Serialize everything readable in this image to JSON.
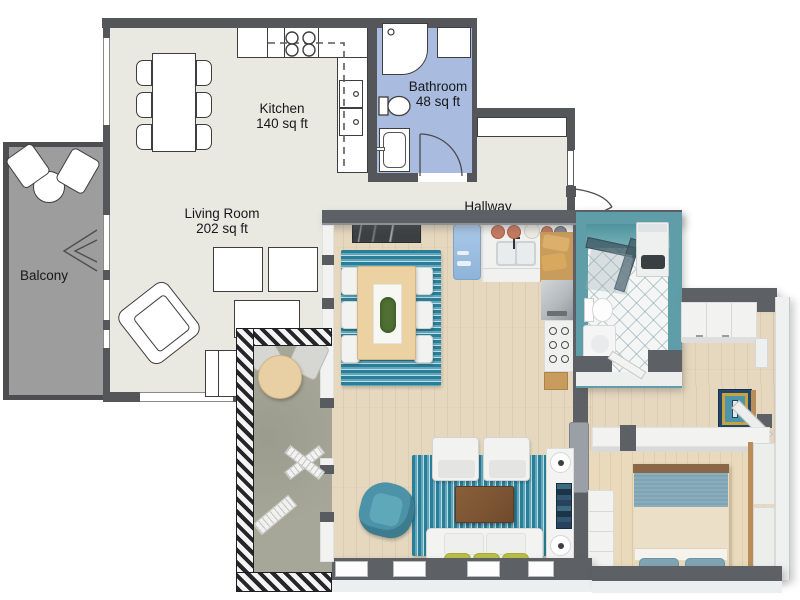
{
  "plan2d": {
    "rooms": {
      "kitchen": {
        "name": "Kitchen",
        "area": "140 sq ft"
      },
      "living_room": {
        "name": "Living Room",
        "area": "202 sq ft"
      },
      "bathroom": {
        "name": "Bathroom",
        "area": "48 sq ft"
      },
      "hallway": {
        "name": "Hallway"
      },
      "balcony": {
        "name": "Balcony"
      }
    }
  },
  "colors": {
    "wall2d": "#54565a",
    "floor2d": "#e9e8e1",
    "bath2d": "#a9bcdf",
    "balcony2d": "#9d9d9d",
    "wall3d": "#5d6166",
    "white3d": "#f2f3f1",
    "wood3d": "#e6d8bf",
    "woodbed": "#e9dabc",
    "rugdark": "#2c7d96",
    "rugmid": "#5ea7bc",
    "ruglight": "#bfdbe3",
    "tealchair": "#4c93a7",
    "cushion": "#b9c046",
    "fridge": "#a9c9e8",
    "bathteal": "#5f9ea8",
    "tile": "#f4f6f6",
    "navyrug": "#24456b",
    "goldrug": "#c8a23c",
    "tablewood": "#ecd2a3",
    "coffeetable": "#7b5433",
    "blanket": "#7fa5b5",
    "duvet": "#ebdfc8",
    "headboard": "#8a6847",
    "balcony3d": "#a7a799",
    "hood": "#b4b9be"
  }
}
